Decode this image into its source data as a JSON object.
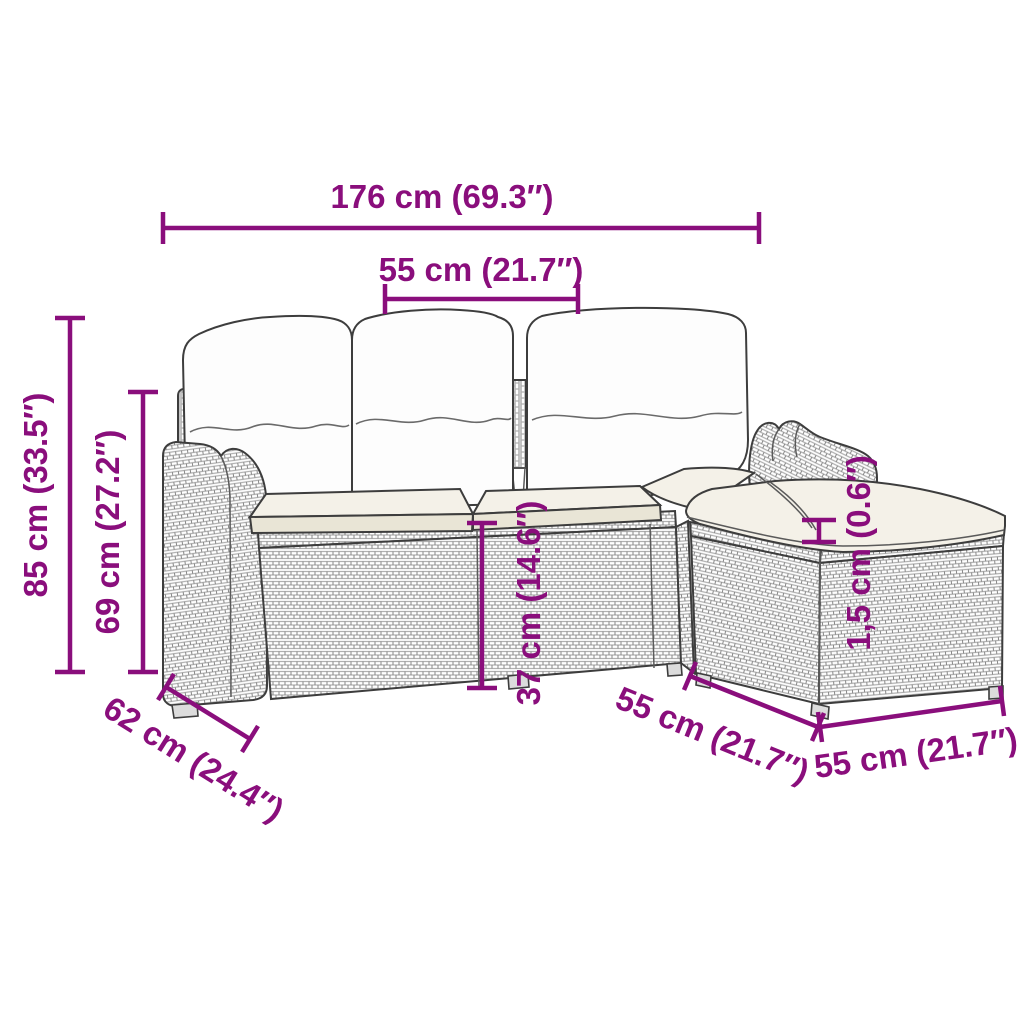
{
  "diagram": {
    "type": "product-dimension-diagram",
    "product": "rattan garden sofa set with cushions and ottoman"
  },
  "colors": {
    "dimension": "#8a0e7c",
    "outline": "#3d3d3d",
    "weave": "#b0b0b0",
    "weave2": "#878787",
    "cushion": "#f4f1e8",
    "pillow": "#fdfdfd",
    "background": "#ffffff"
  },
  "dimensions": {
    "total_width": {
      "label": "176 cm (69.3″)"
    },
    "seat_width": {
      "label": "55 cm (21.7″)"
    },
    "total_height": {
      "label": "85 cm (33.5″)"
    },
    "back_height": {
      "label": "69 cm (27.2″)"
    },
    "seat_height": {
      "label": "37 cm (14.6″)"
    },
    "cushion_thickness": {
      "label": "1,5 cm (0.6″)"
    },
    "depth": {
      "label": "62 cm (24.4″)"
    },
    "ottoman_depth": {
      "label": "55 cm (21.7″)"
    },
    "ottoman_width": {
      "label": "55 cm (21.7″)"
    }
  }
}
